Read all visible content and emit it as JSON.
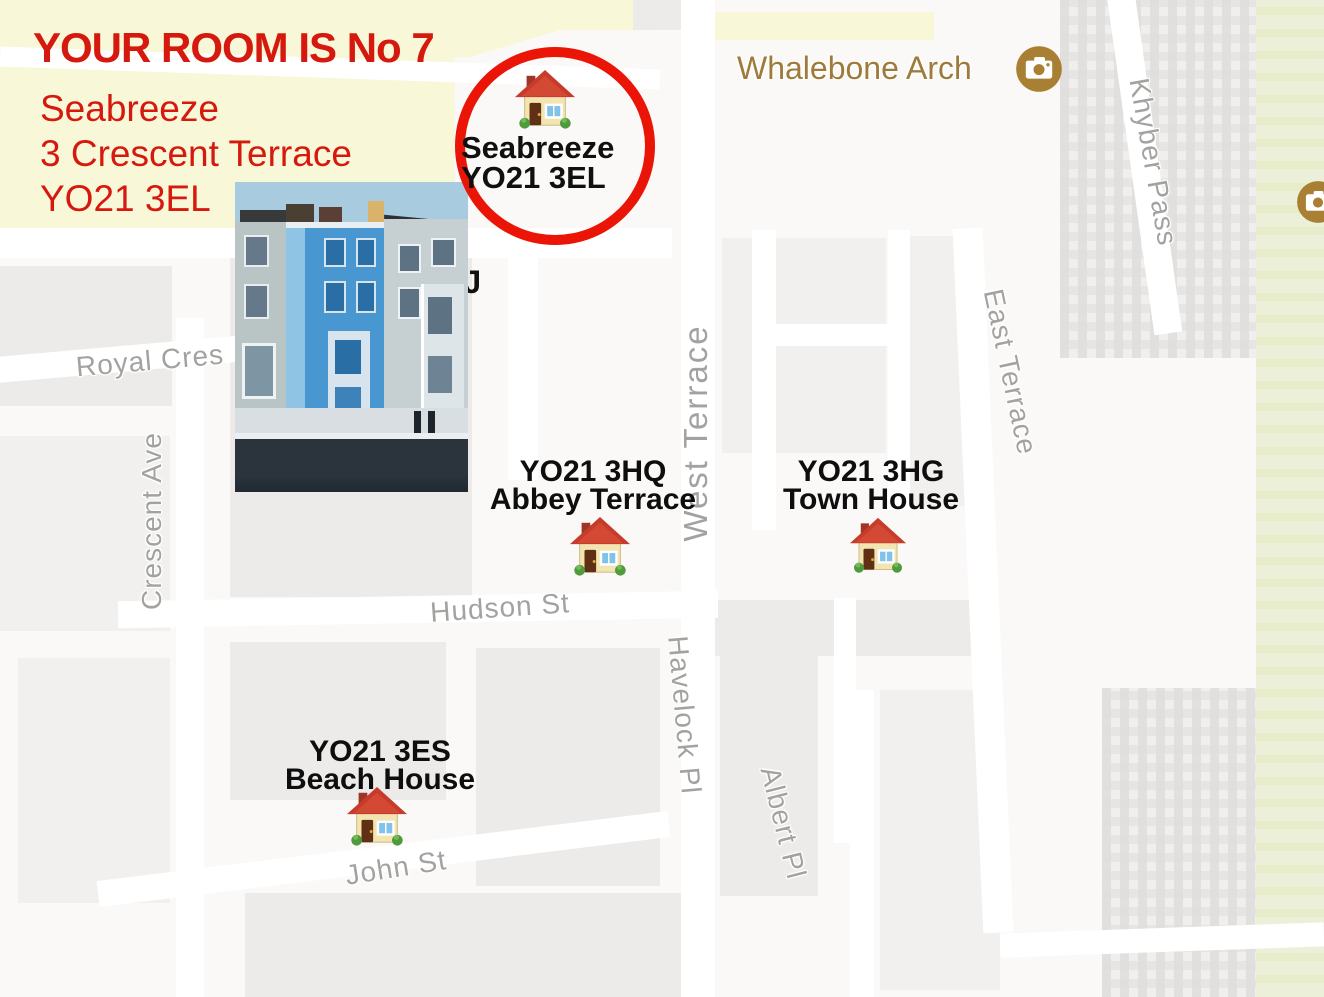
{
  "annotation": {
    "title": "YOUR ROOM IS No 7",
    "address": [
      "Seabreeze",
      "3 Crescent Terrace",
      "YO21 3EL"
    ],
    "text_color": "#d6190e"
  },
  "highlight": {
    "name": "Seabreeze",
    "postcode": "YO21 3EL",
    "circle_color": "#ea1507"
  },
  "partial_label": "EJ",
  "pois": {
    "whalebone_arch": {
      "label": "Whalebone Arch",
      "icon": "camera-icon",
      "color": "#9e7b3a"
    }
  },
  "properties": [
    {
      "postcode": "YO21 3HQ",
      "name": "Abbey Terrace"
    },
    {
      "postcode": "YO21 3HG",
      "name": "Town House"
    },
    {
      "postcode": "YO21 3ES",
      "name": "Beach House"
    }
  ],
  "streets": {
    "royal_cres": "Royal Cres",
    "crescent_ave": "Crescent Ave",
    "west_terrace": "West Terrace",
    "east_terrace": "East Terrace",
    "khyber_pass": "Khyber Pass",
    "hudson_st": "Hudson St",
    "havelock_pl": "Havelock Pl",
    "albert_pl": "Albert Pl",
    "john_st": "John St"
  },
  "map_colors": {
    "land": "#faf9f7",
    "block": "#ecebe9",
    "road": "#ffffff",
    "park": "#edf0d8",
    "sand": "#f8f7d8",
    "street_label": "#a3a2a0"
  }
}
